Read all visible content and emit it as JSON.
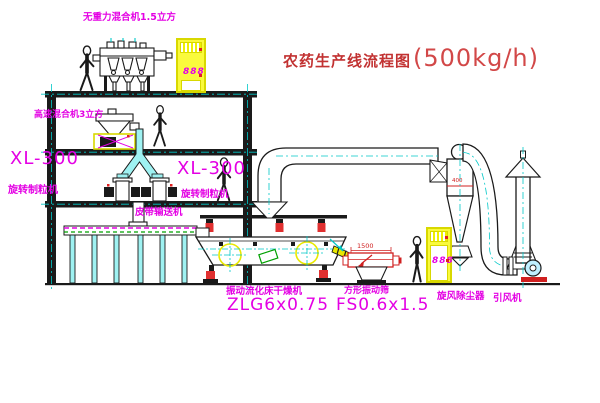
{
  "title": {
    "main": "农药生产线流程图",
    "capacity": "(500kg/h)"
  },
  "equipment_labels": {
    "zero_gravity_mixer": "无重力混合机1.5立方",
    "high_speed_mixer": "高速混合机3立方",
    "left_granulator": {
      "model": "XL-300",
      "name": "旋转制粒机"
    },
    "right_granulator": {
      "model": "XL-300",
      "name": "旋转制粒机"
    },
    "belt_conveyor": "皮带输送机",
    "dryer": {
      "name": "振动流化床干燥机",
      "model": "ZLG6x0.75"
    },
    "sieve": {
      "name": "方形振动筛",
      "model": "FS0.6x1.5",
      "dimension": "1500"
    },
    "cyclone": {
      "name": "旋风除尘器",
      "dimension": "400"
    },
    "fan": {
      "name": "引风机"
    }
  },
  "control_cabinets": {
    "upper_display": "888",
    "lower_display": "888"
  },
  "colors": {
    "label_magenta": "#e400e4",
    "title_red": "#c23232",
    "cabinet_yellow": "#f0f000",
    "centerline_cyan": "#00c8c8",
    "spring_red": "#e03030",
    "motor_green": "#00a000",
    "line_black": "#1a1a1a"
  }
}
